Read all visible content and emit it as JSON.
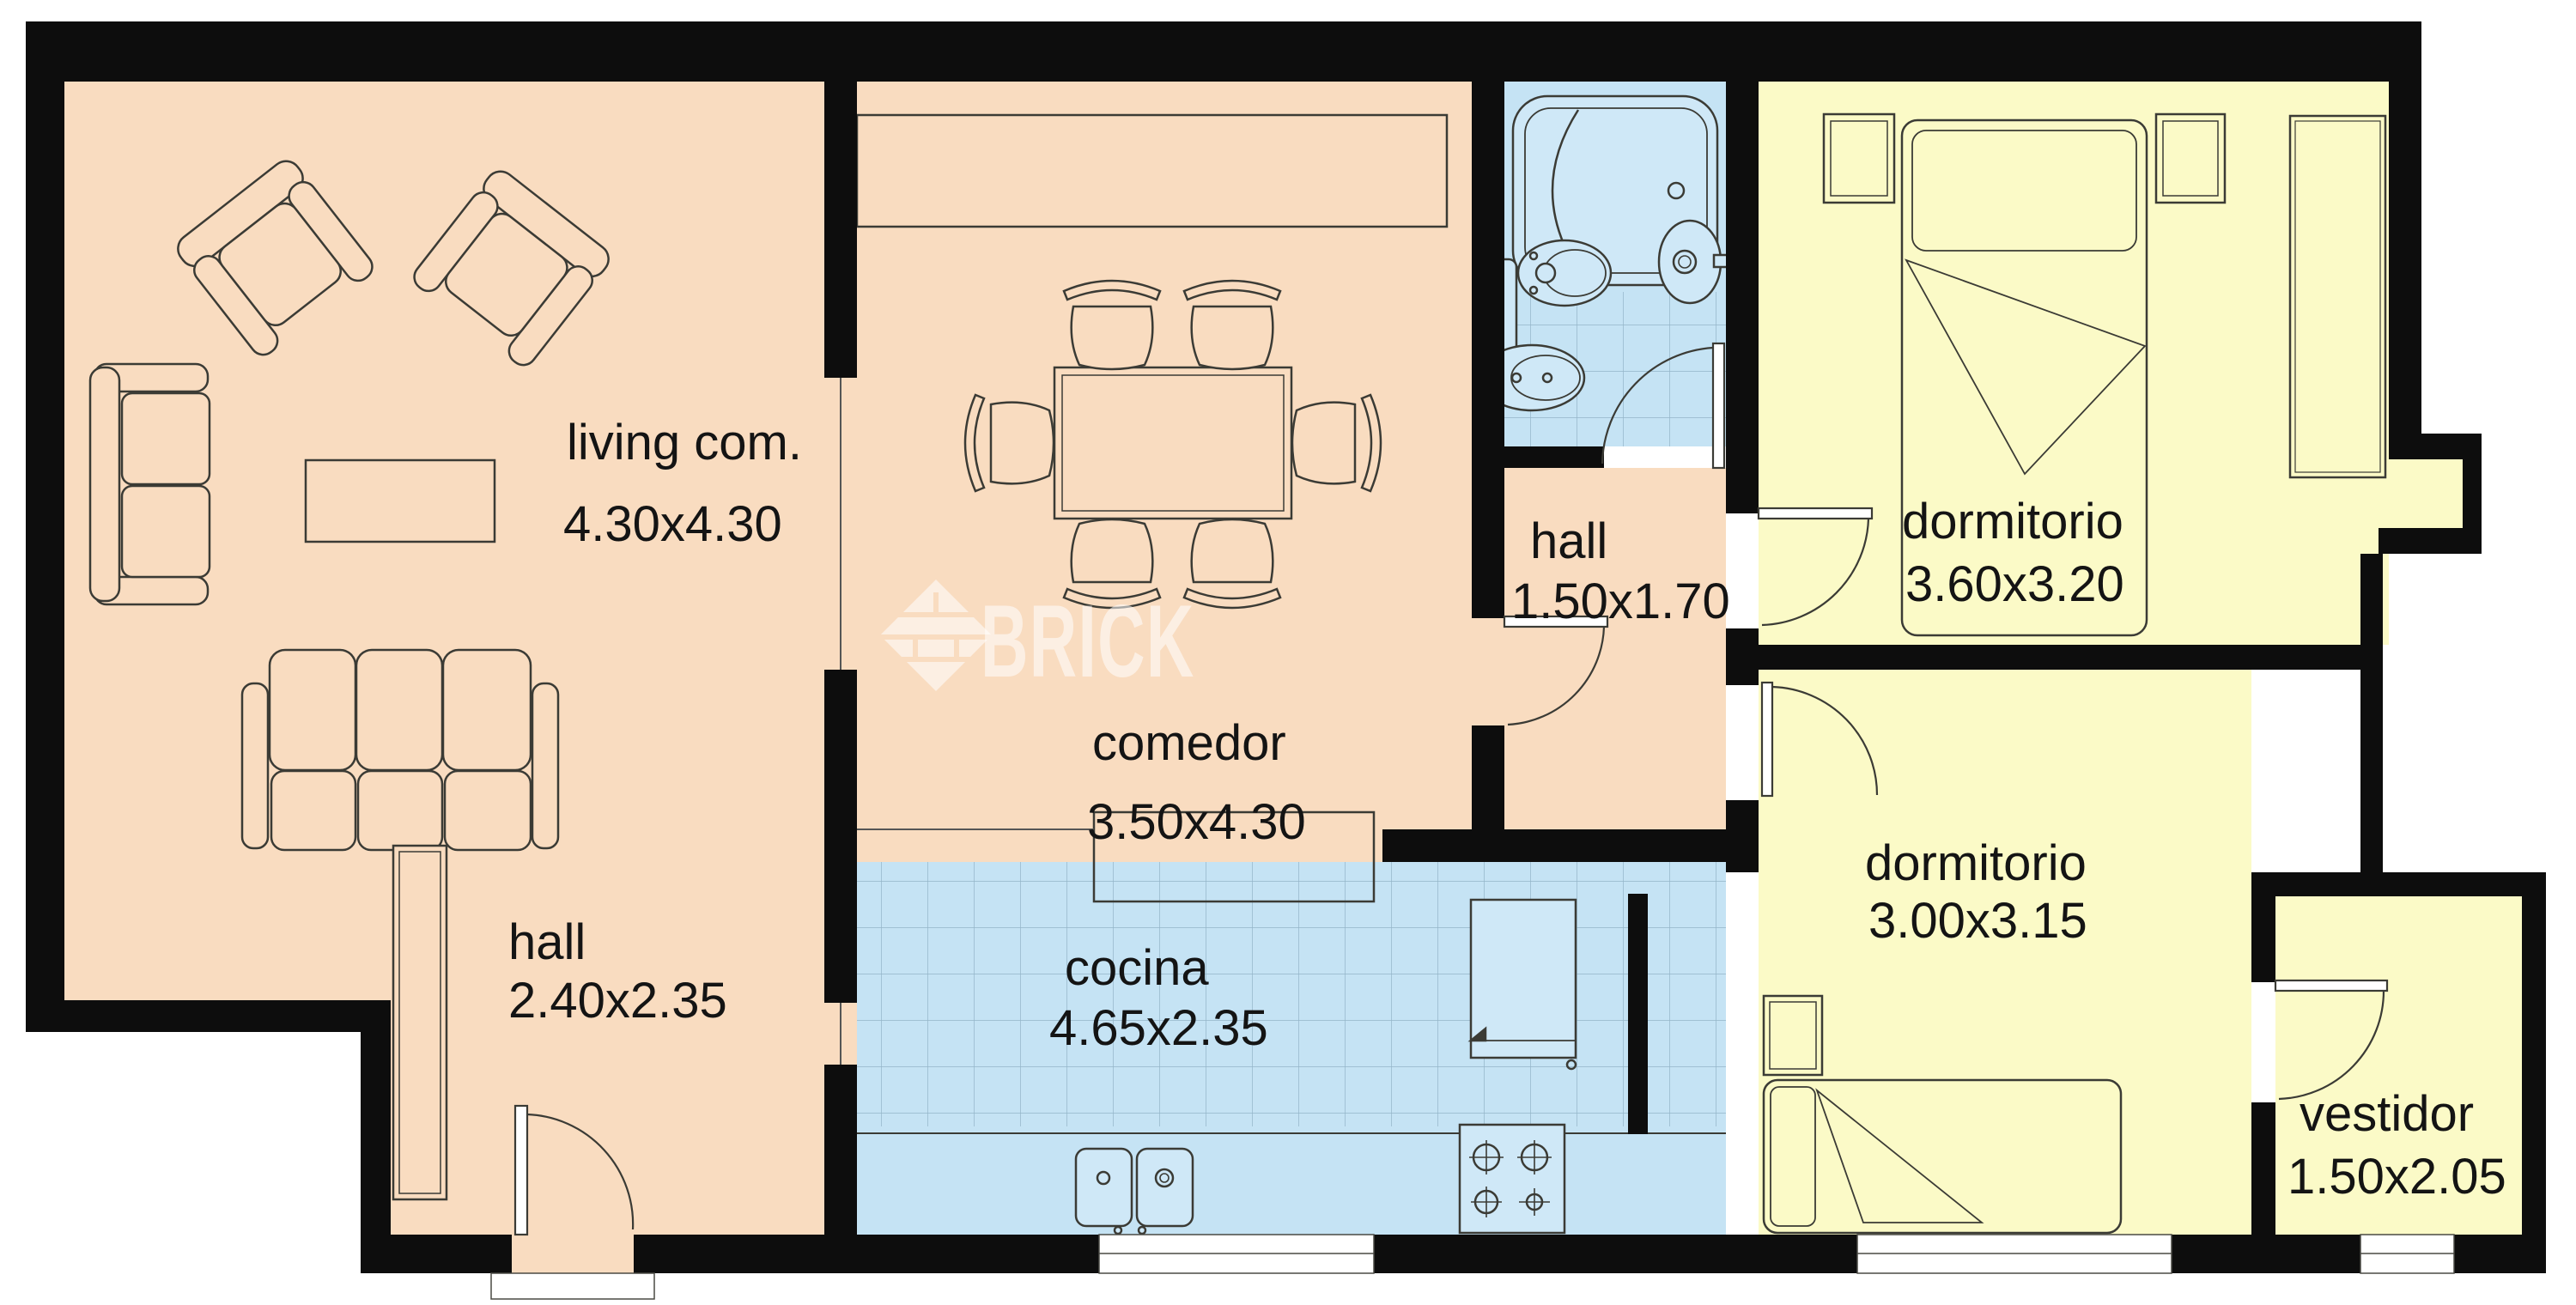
{
  "watermark": {
    "text": "BRICK"
  },
  "rooms": {
    "living": {
      "name": "living com.",
      "dims": "4.30x4.30"
    },
    "comedor": {
      "name": "comedor",
      "dims": "3.50x4.30"
    },
    "hall_top": {
      "name": "hall",
      "dims": "1.50x1.70"
    },
    "dormitorio1": {
      "name": "dormitorio",
      "dims": "3.60x3.20"
    },
    "dormitorio2": {
      "name": "dormitorio",
      "dims": "3.00x3.15"
    },
    "hall_bottom": {
      "name": "hall",
      "dims": "2.40x2.35"
    },
    "cocina": {
      "name": "cocina",
      "dims": "4.65x2.35"
    },
    "vestidor": {
      "name": "vestidor",
      "dims": "1.50x2.05"
    }
  },
  "colors": {
    "wall": "#0d0d0d",
    "living_fill": "#f9dcc0",
    "bedroom_fill": "#fbfac7",
    "wet_fill": "#c5e3f4",
    "fixture_fill": "#cfe8f7",
    "tile_line": "#93b4c8",
    "outline": "#3b3b35",
    "watermark_fill": "rgba(255,255,255,0.55)"
  }
}
